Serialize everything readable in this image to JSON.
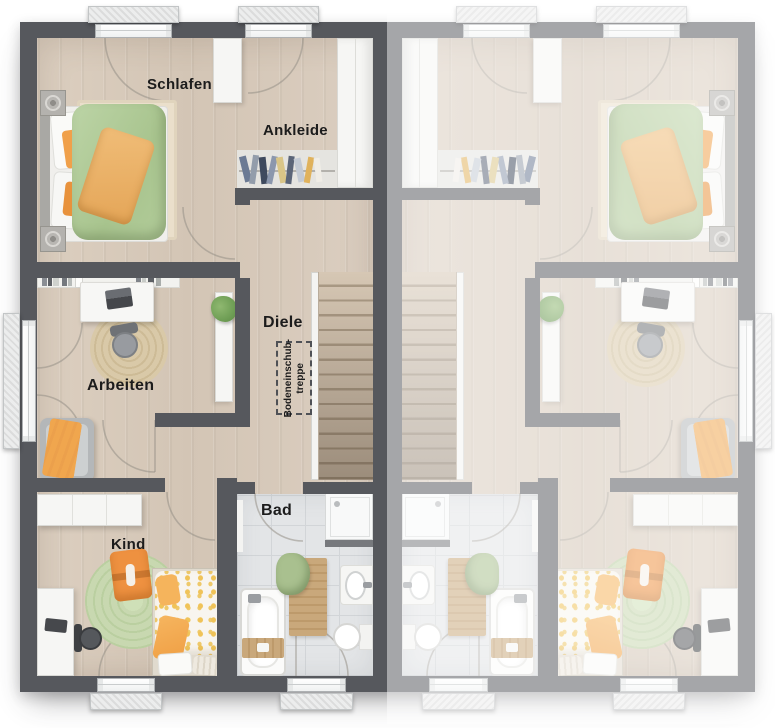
{
  "building": {
    "type": "duplex-upper-floor-plan",
    "units": [
      {
        "side": "left",
        "labeled": true
      },
      {
        "side": "right",
        "labeled": false,
        "mirrored": true,
        "washed_out": true
      }
    ]
  },
  "labels": {
    "schlafen": "Schlafen",
    "ankleide": "Ankleide",
    "diele": "Diele",
    "arbeiten": "Arbeiten",
    "kind": "Kind",
    "bad": "Bad",
    "attic_line1": "Bodeneinschub-",
    "attic_line2": "treppe"
  },
  "colors": {
    "wall_dark": "#56585d",
    "wall_washed": "#a2a4a7",
    "floor_wood": "#d8cbbc",
    "floor_bath": "#e3e5e7",
    "stairs_wood": "#cbbca9",
    "duvet_green": "#b2cc9a",
    "blanket_orange": "#ecb166",
    "accent_orange": "#ee8f3c",
    "play_rug_green": "#c8d8b0",
    "jute_rug": "#d8c8a6",
    "wood_accessory": "#c9a87b",
    "towel_green": "#a9c08f",
    "duvet_dots_yellow": "#f0c358",
    "label_text": "#1c1c1c",
    "background": "#ffffff"
  }
}
